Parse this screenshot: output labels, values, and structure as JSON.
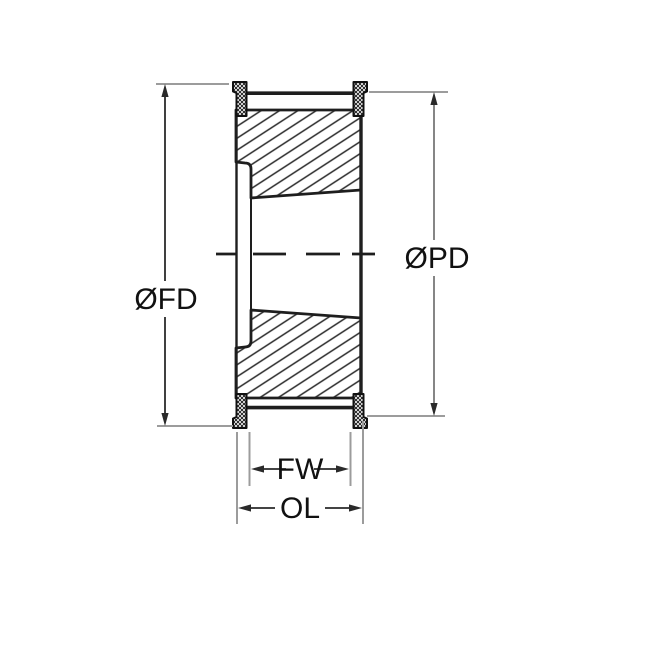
{
  "drawing": {
    "dimensions": {
      "flange_diameter": {
        "label": "ØFD"
      },
      "pitch_diameter": {
        "label": "ØPD"
      },
      "face_width": {
        "label": "FW"
      },
      "overall_length": {
        "label": "OL"
      }
    },
    "colors": {
      "line": "#1e1e1e",
      "hatch": "#2a2a2a",
      "extension_line": "#9c9c9c",
      "pd_dimension_line": "#787878",
      "label_text": "#111111",
      "background": "#ffffff"
    }
  }
}
